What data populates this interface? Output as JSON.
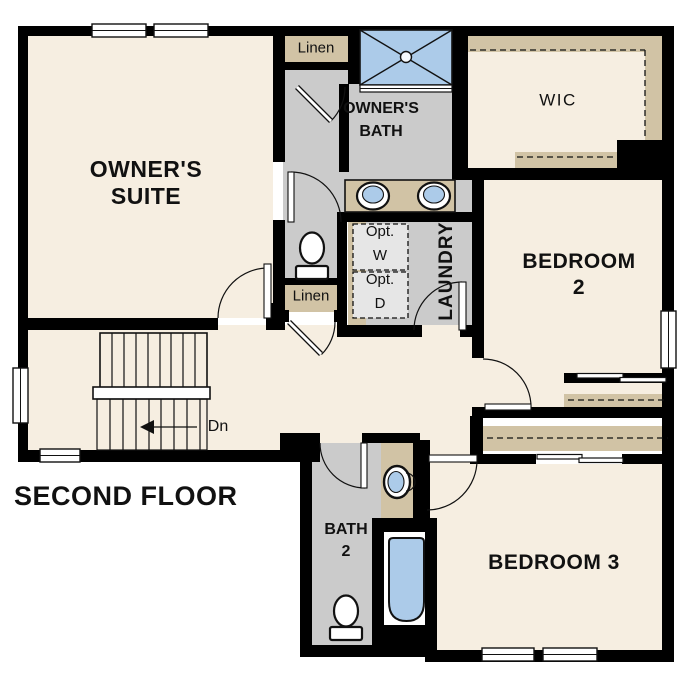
{
  "title": "SECOND FLOOR",
  "colors": {
    "floor": "#f6eee1",
    "wet_floor": "#cbcbcb",
    "cabinetry": "#d1c3a5",
    "fixture_blue": "#accbe9",
    "appliance_fill": "#e6e6e6",
    "wall": "#000000"
  },
  "rooms": {
    "owners_suite": {
      "label": "OWNER'S\nSUITE"
    },
    "owners_bath": {
      "label": "OWNER'S\nBATH"
    },
    "wic": {
      "label": "WIC"
    },
    "laundry": {
      "label": "LAUNDRY"
    },
    "bedroom_2": {
      "label": "BEDROOM 2"
    },
    "bedroom_3": {
      "label": "BEDROOM 3"
    },
    "bath_2": {
      "label": "BATH\n2"
    }
  },
  "closets": {
    "linen_upper": {
      "label": "Linen"
    },
    "linen_hall": {
      "label": "Linen"
    }
  },
  "appliances": {
    "optional_washer": {
      "label": "Opt.\nW"
    },
    "optional_dryer": {
      "label": "Opt.\nD"
    }
  },
  "stairs": {
    "down_label": "Dn"
  }
}
